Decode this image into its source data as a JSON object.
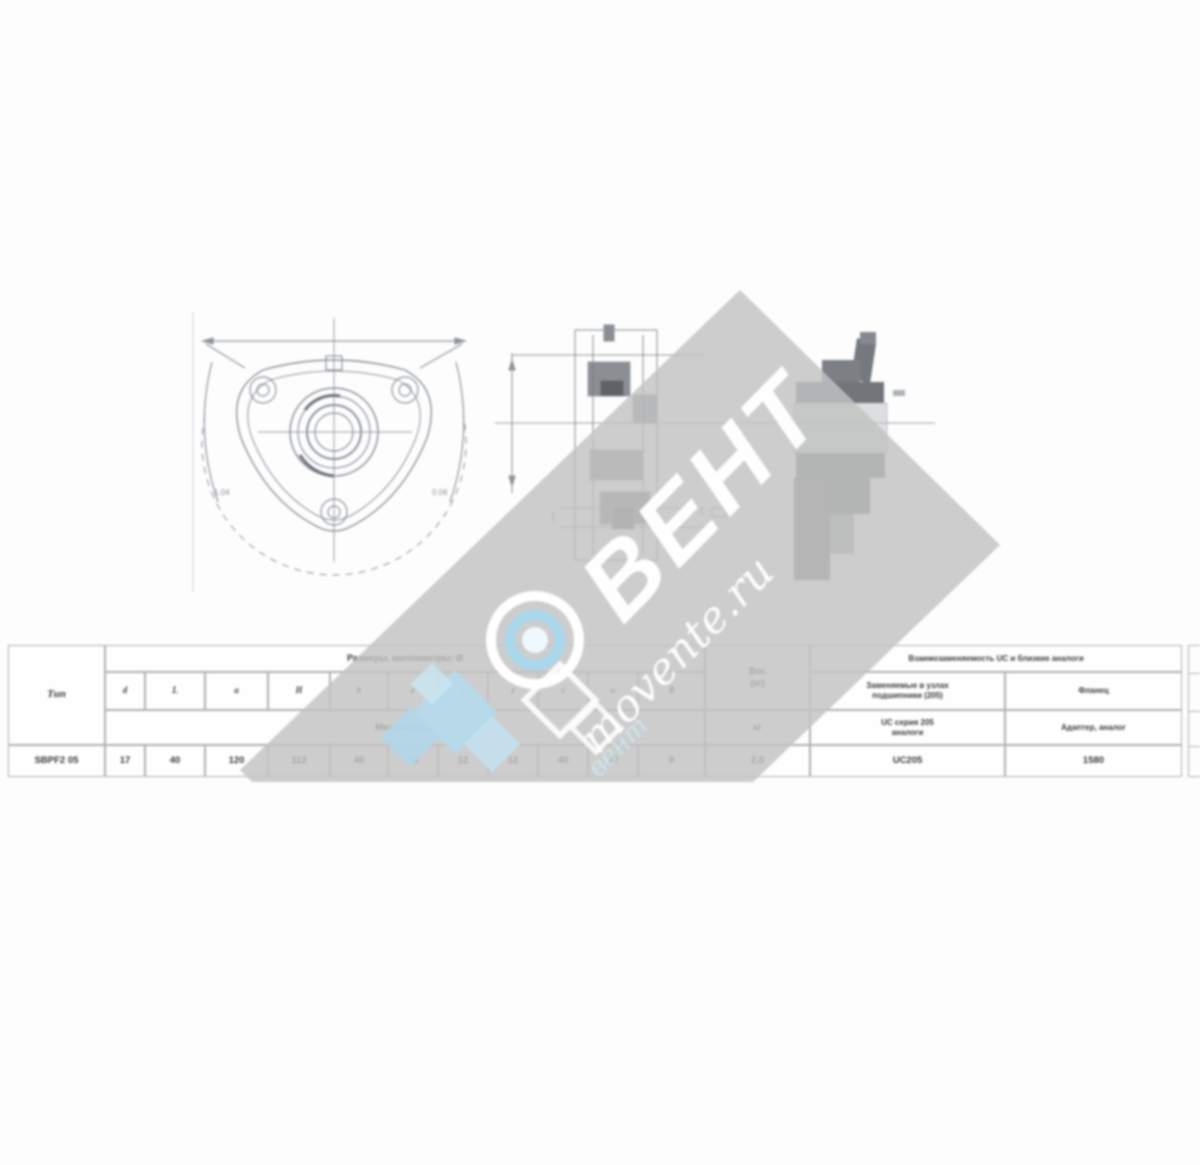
{
  "watermark": {
    "brand": "ВЕНТ",
    "site": "movente.ru",
    "script_small": "вент",
    "band_gray": "#c2c2c2",
    "accent_blue": "#aed8ec"
  },
  "drawing_labels": {
    "front_left": "1.04",
    "front_right": "0.06",
    "section_a": "A"
  },
  "table": {
    "type_header": "Тип",
    "dims_group_header": "Размеры, миллиметры: Ø",
    "dims_letters": [
      "d",
      "L",
      "a",
      "Н",
      "b",
      "e",
      "ø",
      "z",
      "s",
      "w",
      "B"
    ],
    "dims_subheader": "Миллиметры",
    "weight_header_l1": "Вес",
    "weight_header_l2": "(кг)",
    "weight_unit": "кг",
    "interch_header": "Взаимозаменяемость UC и близкие аналоги",
    "interch_col1_line1": "Заменяемые в узлах",
    "interch_col1_line2": "подшипники (205)",
    "interch_col2": "Фланец",
    "interch_col1b_line1": "UC серия 205",
    "interch_col1b_line2": "аналоги",
    "interch_col2b": "Адаптер, аналог",
    "row": {
      "type": "SBPF2 05",
      "dims": [
        "17",
        "40",
        "120",
        "112",
        "40",
        "16",
        "12",
        "12",
        "40",
        "12",
        "9"
      ],
      "weight": "2,0",
      "interch1": "UC205",
      "interch2": "1580"
    }
  }
}
